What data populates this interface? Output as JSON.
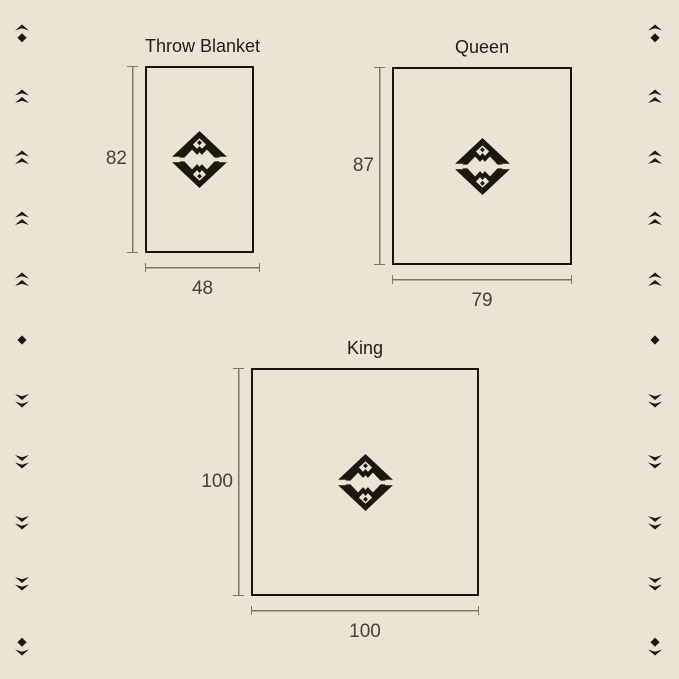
{
  "palette": {
    "background": "#EBE3D4",
    "outline_ink": "#17150F",
    "logo_ink": "#1B1810",
    "dimension_line": "#7F7769",
    "number_text": "#46413A",
    "title_text": "#201D17"
  },
  "scale_px_per_inch": 2.28,
  "diagrams": [
    {
      "id": "throw",
      "title": "Throw Blanket",
      "width_in": 48,
      "height_in": 82,
      "width_label": "48",
      "height_label": "82"
    },
    {
      "id": "queen",
      "title": "Queen",
      "width_in": 79,
      "height_in": 87,
      "width_label": "79",
      "height_label": "87"
    },
    {
      "id": "king",
      "title": "King",
      "width_in": 100,
      "height_in": 100,
      "width_label": "100",
      "height_label": "100"
    }
  ],
  "logo": {
    "name": "mountain-diamond-monogram"
  },
  "ornaments": {
    "left": [
      "diamond-chevron-up",
      "double-chevron-up",
      "double-chevron-up",
      "double-chevron-up",
      "double-chevron-up",
      "diamond",
      "double-chevron-down",
      "double-chevron-down",
      "double-chevron-down",
      "double-chevron-down",
      "diamond-chevron-down"
    ],
    "right": [
      "diamond-chevron-up",
      "double-chevron-up",
      "double-chevron-up",
      "double-chevron-up",
      "double-chevron-up",
      "diamond",
      "double-chevron-down",
      "double-chevron-down",
      "double-chevron-down",
      "double-chevron-down",
      "diamond-chevron-down"
    ]
  }
}
